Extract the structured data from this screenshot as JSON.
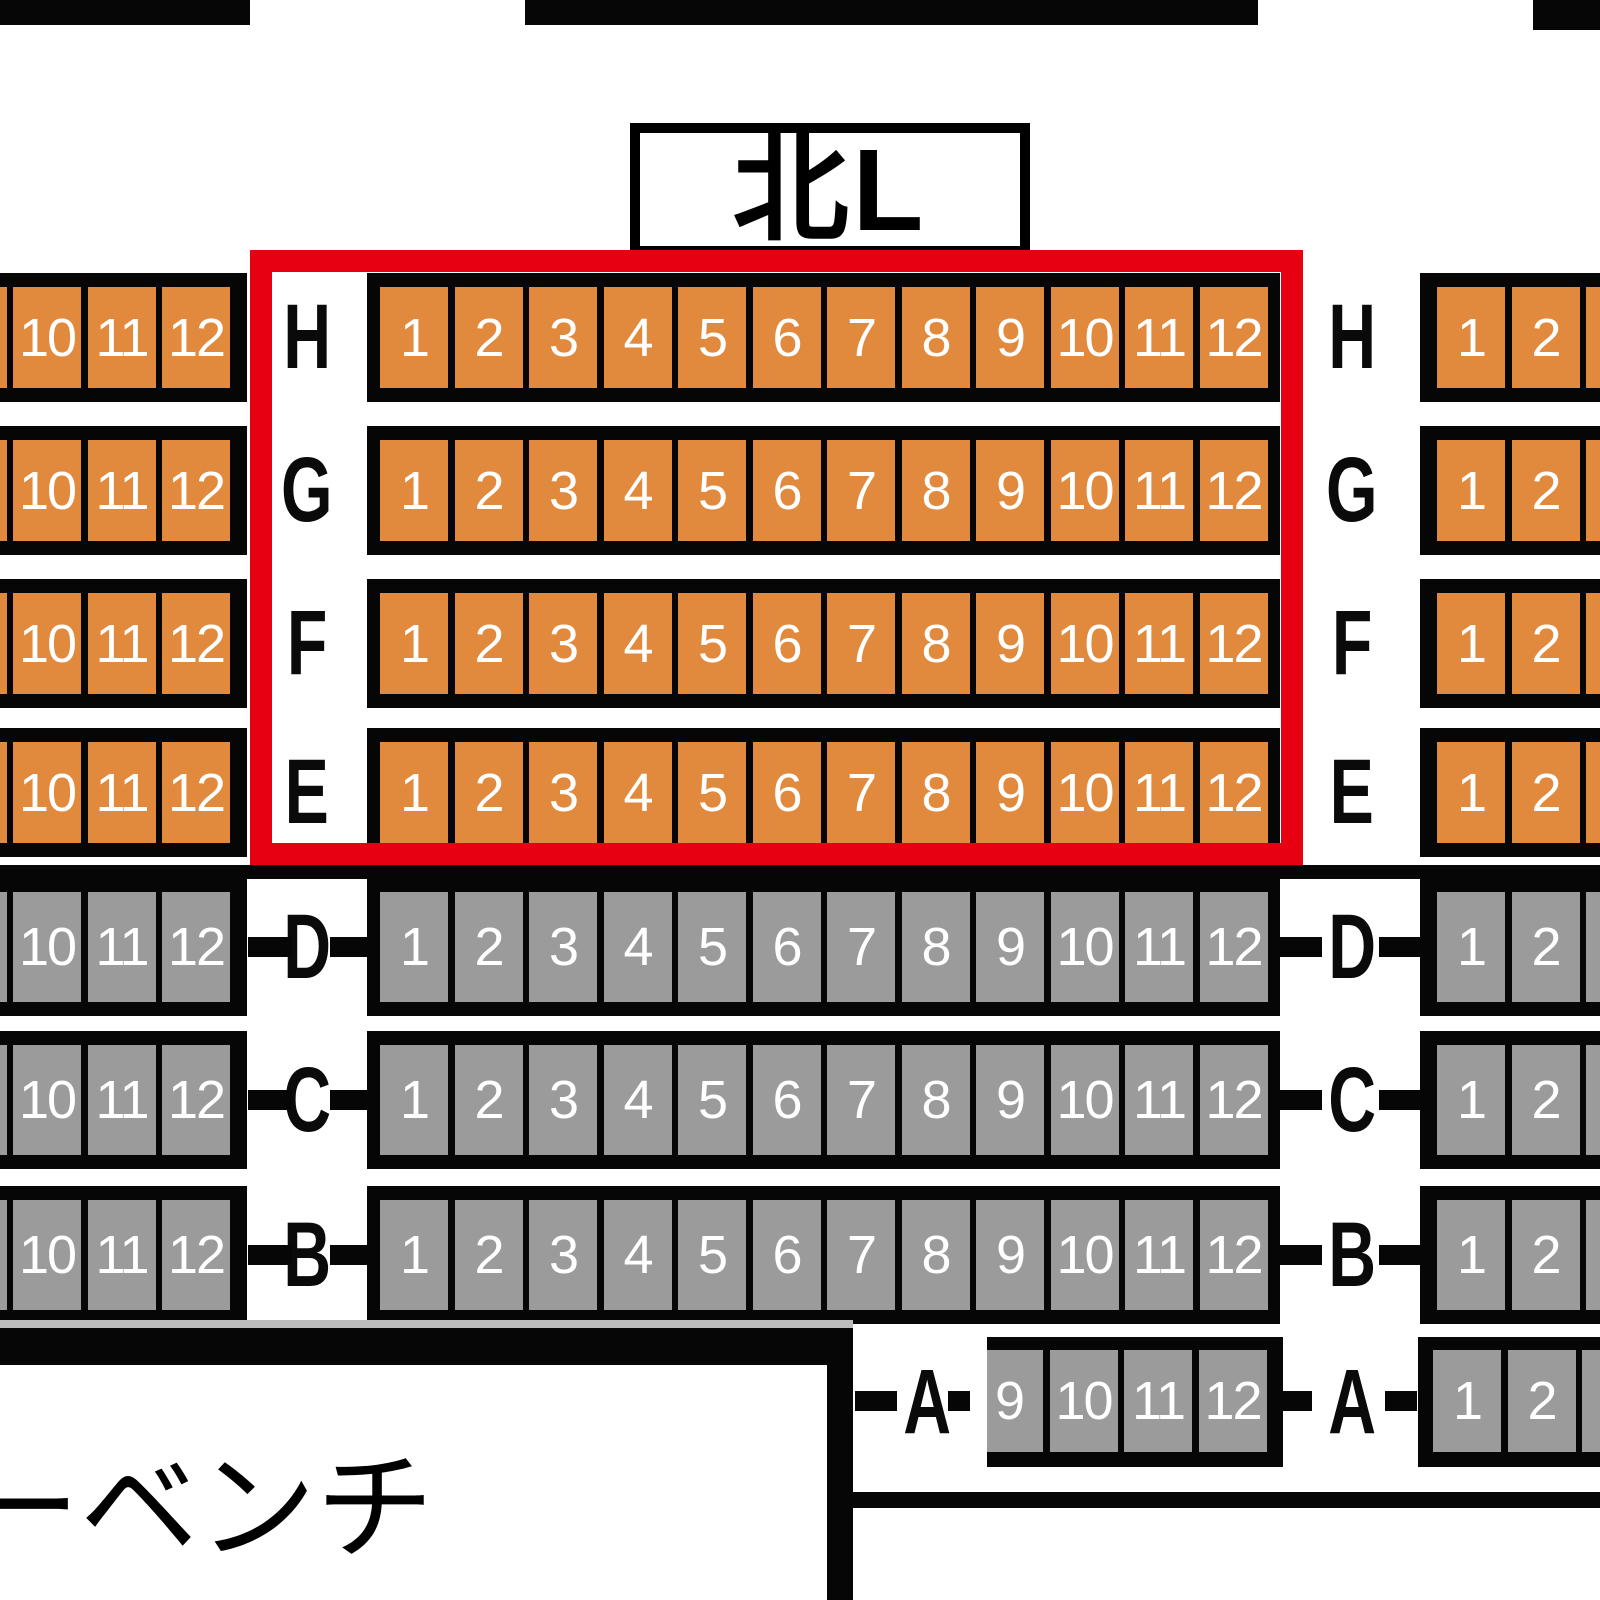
{
  "header": {
    "section_label": "北L"
  },
  "footer": {
    "bench_label": "ーベンチ"
  },
  "colors": {
    "seat_available": "#e18a3e",
    "seat_unavailable": "#9b9b9b",
    "highlight_border": "#e60012",
    "structure": "#060606",
    "seat_number_text": "#ffffff"
  },
  "seat_rows": [
    {
      "letter": "H",
      "status": "available",
      "has_ticks": false,
      "left_seats": [
        "9",
        "10",
        "11",
        "12"
      ],
      "middle_seats": [
        "1",
        "2",
        "3",
        "4",
        "5",
        "6",
        "7",
        "8",
        "9",
        "10",
        "11",
        "12"
      ],
      "right_seats": [
        "1",
        "2",
        "3"
      ]
    },
    {
      "letter": "G",
      "status": "available",
      "has_ticks": false,
      "left_seats": [
        "9",
        "10",
        "11",
        "12"
      ],
      "middle_seats": [
        "1",
        "2",
        "3",
        "4",
        "5",
        "6",
        "7",
        "8",
        "9",
        "10",
        "11",
        "12"
      ],
      "right_seats": [
        "1",
        "2",
        "3"
      ]
    },
    {
      "letter": "F",
      "status": "available",
      "has_ticks": false,
      "left_seats": [
        "9",
        "10",
        "11",
        "12"
      ],
      "middle_seats": [
        "1",
        "2",
        "3",
        "4",
        "5",
        "6",
        "7",
        "8",
        "9",
        "10",
        "11",
        "12"
      ],
      "right_seats": [
        "1",
        "2",
        "3"
      ]
    },
    {
      "letter": "E",
      "status": "available",
      "has_ticks": false,
      "left_seats": [
        "9",
        "10",
        "11",
        "12"
      ],
      "middle_seats": [
        "1",
        "2",
        "3",
        "4",
        "5",
        "6",
        "7",
        "8",
        "9",
        "10",
        "11",
        "12"
      ],
      "right_seats": [
        "1",
        "2",
        "3"
      ]
    },
    {
      "letter": "D",
      "status": "unavailable",
      "has_ticks": true,
      "left_seats": [
        "9",
        "10",
        "11",
        "12"
      ],
      "middle_seats": [
        "1",
        "2",
        "3",
        "4",
        "5",
        "6",
        "7",
        "8",
        "9",
        "10",
        "11",
        "12"
      ],
      "right_seats": [
        "1",
        "2",
        "3"
      ]
    },
    {
      "letter": "C",
      "status": "unavailable",
      "has_ticks": true,
      "left_seats": [
        "9",
        "10",
        "11",
        "12"
      ],
      "middle_seats": [
        "1",
        "2",
        "3",
        "4",
        "5",
        "6",
        "7",
        "8",
        "9",
        "10",
        "11",
        "12"
      ],
      "right_seats": [
        "1",
        "2",
        "3"
      ]
    },
    {
      "letter": "B",
      "status": "unavailable",
      "has_ticks": true,
      "left_seats": [
        "9",
        "10",
        "11",
        "12"
      ],
      "middle_seats": [
        "1",
        "2",
        "3",
        "4",
        "5",
        "6",
        "7",
        "8",
        "9",
        "10",
        "11",
        "12"
      ],
      "right_seats": [
        "1",
        "2",
        "3"
      ]
    }
  ],
  "front_row": {
    "letter": "A",
    "status": "unavailable",
    "has_ticks": true,
    "middle_seats": [
      "9",
      "10",
      "11",
      "12"
    ],
    "right_seats": [
      "1",
      "2",
      "3"
    ]
  }
}
